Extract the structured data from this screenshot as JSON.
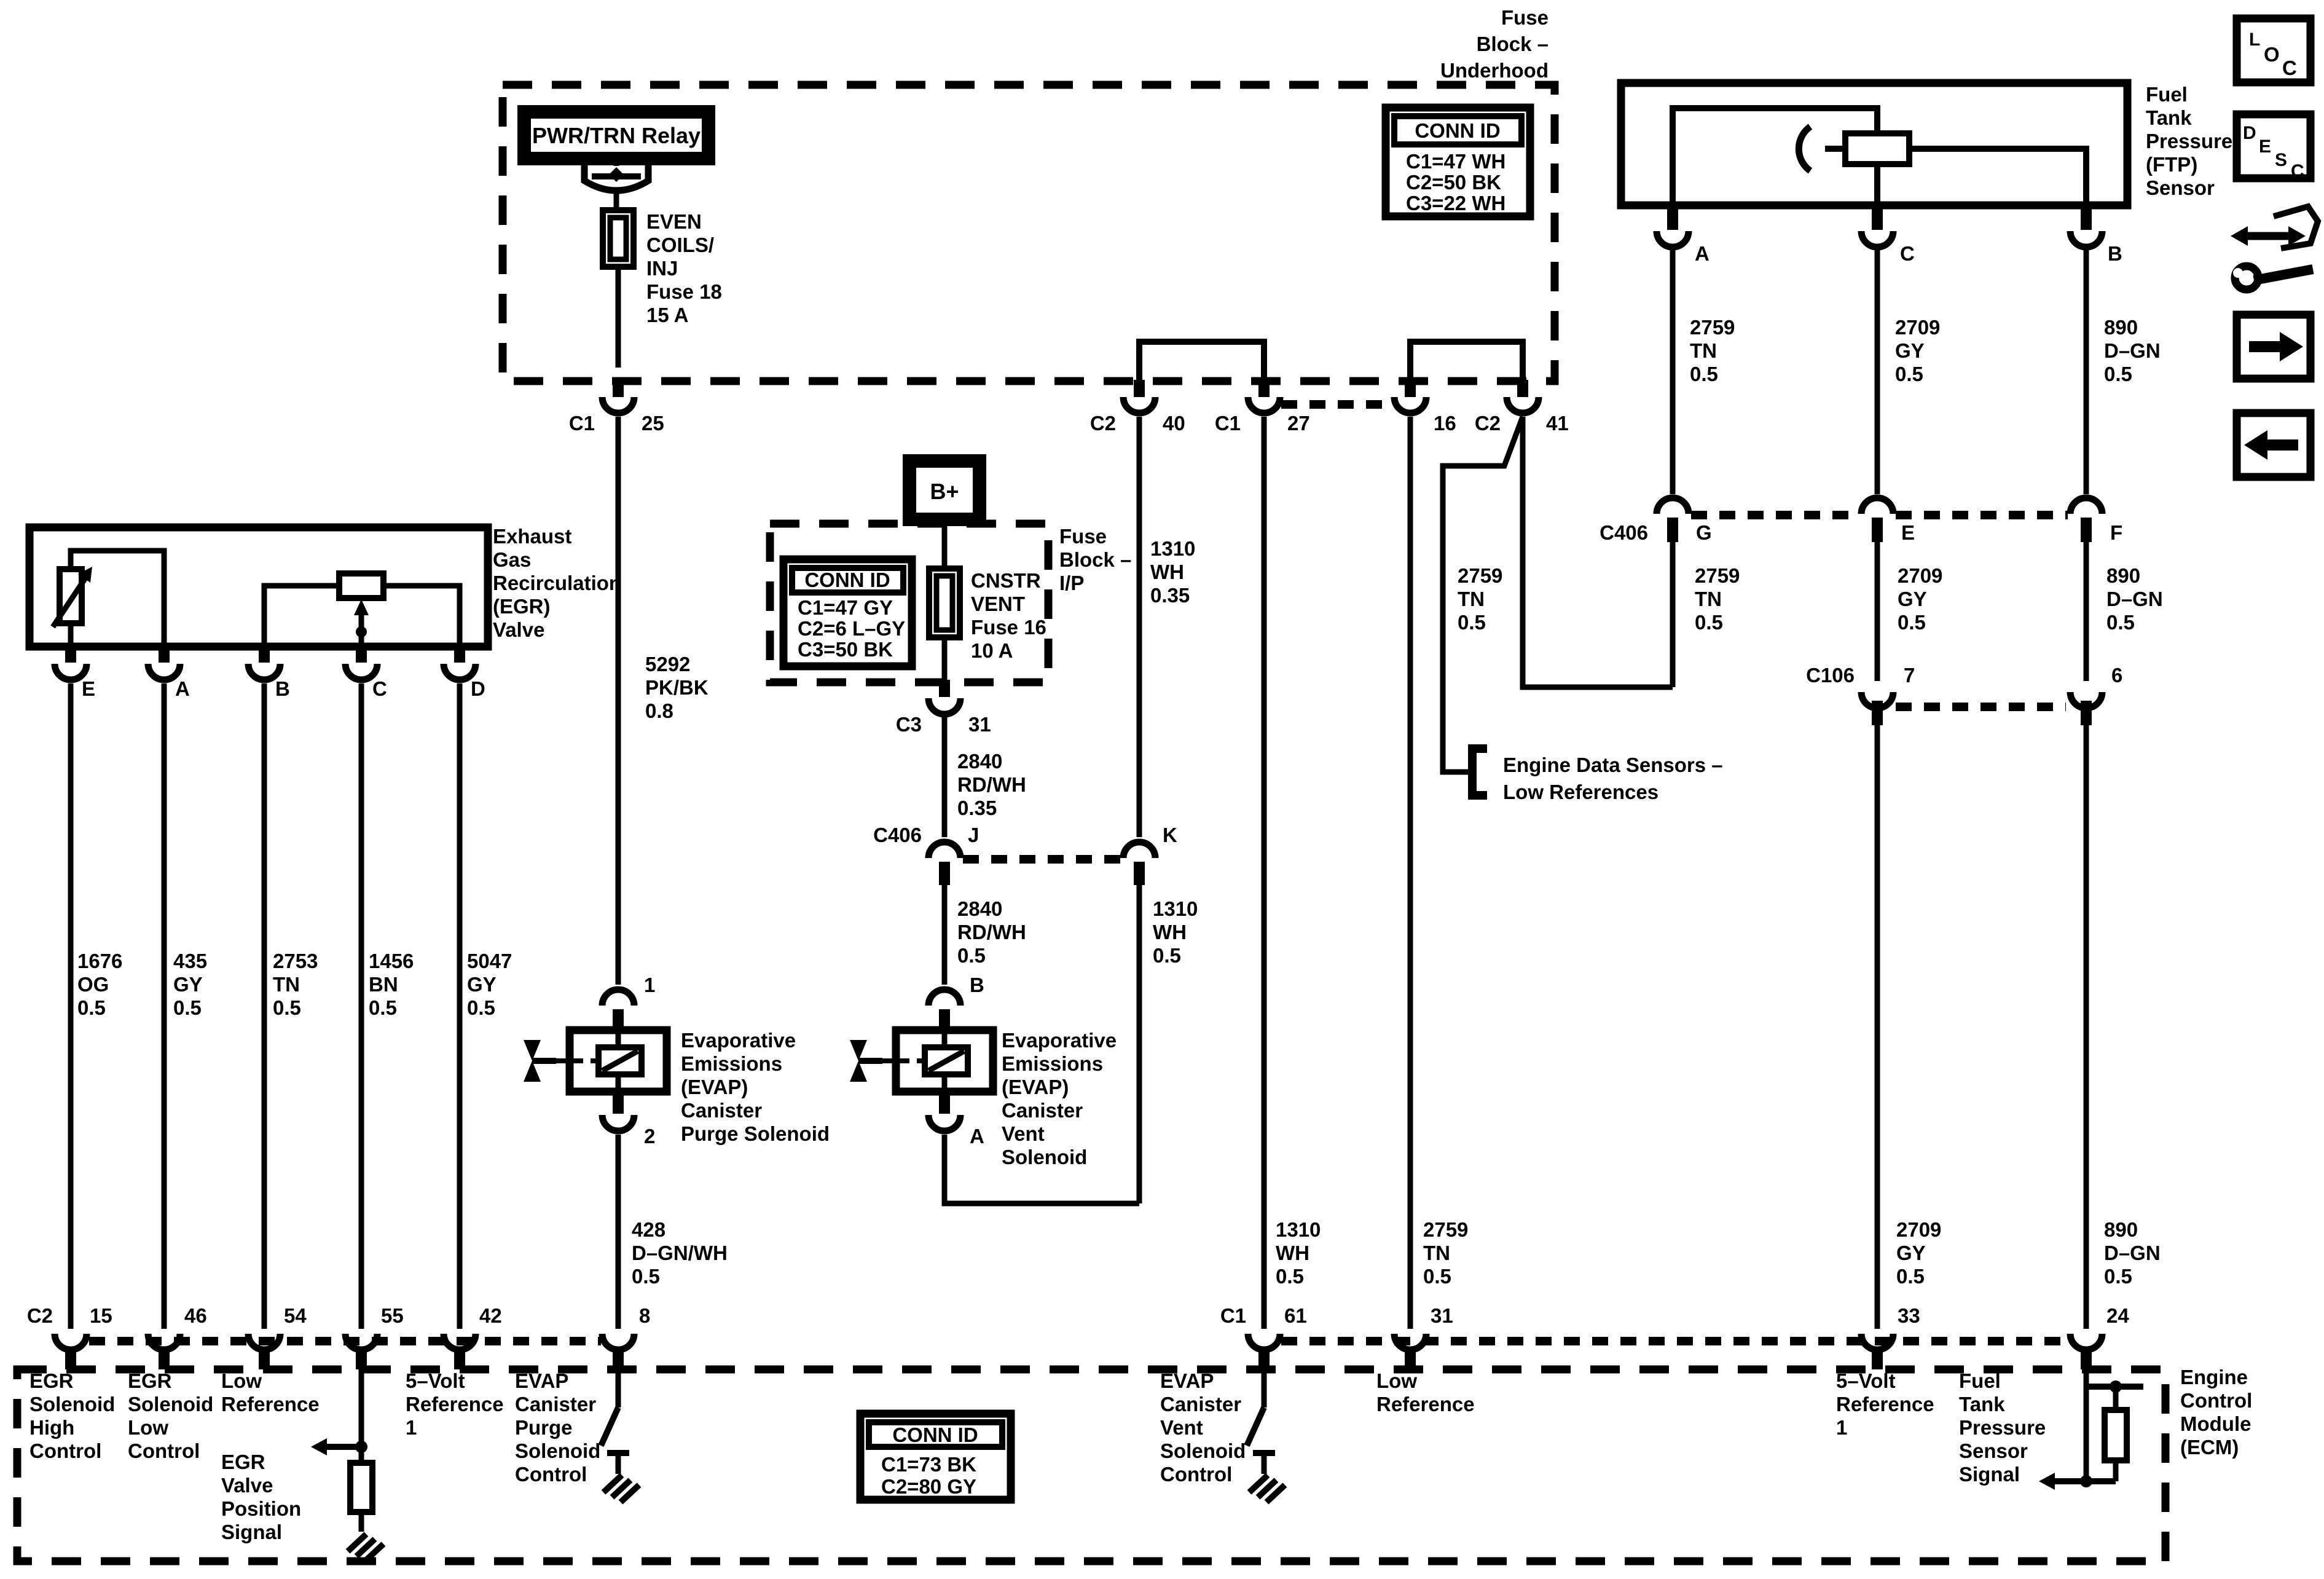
{
  "toolbar": {
    "loc": [
      "L",
      "O",
      "C"
    ],
    "desc": [
      "D",
      "E",
      "S",
      "C"
    ]
  },
  "underhood": {
    "title": [
      "Fuse",
      "Block –",
      "Underhood"
    ],
    "relay": "PWR/TRN Relay",
    "fuse": [
      "EVEN",
      "COILS/",
      "INJ",
      "Fuse 18",
      "15 A"
    ],
    "conn_id": {
      "header": "CONN ID",
      "rows": [
        "C1=47 WH",
        "C2=50 BK",
        "C3=22 WH"
      ]
    },
    "pins": {
      "c1a": "C1",
      "p25": "25",
      "c2a": "C2",
      "p40": "40",
      "c1b": "C1",
      "p27": "27",
      "p16": "16",
      "c2b": "C2",
      "p41": "41"
    }
  },
  "ip_block": {
    "title": [
      "Fuse",
      "Block –",
      "I/P"
    ],
    "bplus": "B+",
    "fuse": [
      "CNSTR",
      "VENT",
      "Fuse 16",
      "10 A"
    ],
    "conn_id": {
      "header": "CONN ID",
      "rows": [
        "C1=47 GY",
        "C2=6 L–GY",
        "C3=50 BK"
      ]
    },
    "pins": {
      "c3": "C3",
      "p31": "31"
    }
  },
  "ftp": {
    "label": [
      "Fuel",
      "Tank",
      "Pressure",
      "(FTP)",
      "Sensor"
    ],
    "pins": {
      "a": "A",
      "c": "C",
      "b": "B"
    }
  },
  "egr": {
    "label": [
      "Exhaust",
      "Gas",
      "Recirculation",
      "(EGR)",
      "Valve"
    ],
    "pins": {
      "e": "E",
      "a": "A",
      "b": "B",
      "c": "C",
      "d": "D"
    }
  },
  "purge": {
    "label": [
      "Evaporative",
      "Emissions",
      "(EVAP)",
      "Canister",
      "Purge Solenoid"
    ],
    "pins": {
      "p1": "1",
      "p2": "2"
    }
  },
  "vent": {
    "label": [
      "Evaporative",
      "Emissions",
      "(EVAP)",
      "Canister",
      "Vent",
      "Solenoid"
    ],
    "pins": {
      "b": "B",
      "a": "A"
    }
  },
  "c406L": {
    "name": "C406",
    "j": "J",
    "k": "K"
  },
  "c406R": {
    "name": "C406",
    "g": "G",
    "e": "E",
    "f": "F"
  },
  "c106": {
    "name": "C106",
    "p7": "7",
    "p6": "6"
  },
  "note": [
    "Engine Data Sensors –",
    "Low References"
  ],
  "wires": {
    "w5292": [
      "5292",
      "PK/BK",
      "0.8"
    ],
    "w1676": [
      "1676",
      "OG",
      "0.5"
    ],
    "w435": [
      "435",
      "GY",
      "0.5"
    ],
    "w2753": [
      "2753",
      "TN",
      "0.5"
    ],
    "w1456": [
      "1456",
      "BN",
      "0.5"
    ],
    "w5047": [
      "5047",
      "GY",
      "0.5"
    ],
    "w428": [
      "428",
      "D–GN/WH",
      "0.5"
    ],
    "w2840a": [
      "2840",
      "RD/WH",
      "0.35"
    ],
    "w2840b": [
      "2840",
      "RD/WH",
      "0.5"
    ],
    "w1310a": [
      "1310",
      "WH",
      "0.35"
    ],
    "w1310b": [
      "1310",
      "WH",
      "0.5"
    ],
    "w1310c": [
      "1310",
      "WH",
      "0.5"
    ],
    "w2759a": [
      "2759",
      "TN",
      "0.5"
    ],
    "w2759b": [
      "2759",
      "TN",
      "0.5"
    ],
    "w2759c": [
      "2759",
      "TN",
      "0.5"
    ],
    "w2759d": [
      "2759",
      "TN",
      "0.5"
    ],
    "w2709a": [
      "2709",
      "GY",
      "0.5"
    ],
    "w2709b": [
      "2709",
      "GY",
      "0.5"
    ],
    "w2709c": [
      "2709",
      "GY",
      "0.5"
    ],
    "w890a": [
      "890",
      "D–GN",
      "0.5"
    ],
    "w890b": [
      "890",
      "D–GN",
      "0.5"
    ],
    "w890c": [
      "890",
      "D–GN",
      "0.5"
    ]
  },
  "ecm": {
    "label": [
      "Engine",
      "Control",
      "Module",
      "(ECM)"
    ],
    "conn_id": {
      "header": "CONN ID",
      "rows": [
        "C1=73 BK",
        "C2=80 GY"
      ]
    },
    "pins": {
      "c2": "C2",
      "p15": "15",
      "p46": "46",
      "p54": "54",
      "p55": "55",
      "p42": "42",
      "p8": "8",
      "c1": "C1",
      "p61": "61",
      "p31": "31",
      "p33": "33",
      "p24": "24"
    },
    "fn": {
      "egr_high": [
        "EGR",
        "Solenoid",
        "High",
        "Control"
      ],
      "egr_low": [
        "EGR",
        "Solenoid",
        "Low",
        "Control"
      ],
      "low_ref_l": [
        "Low",
        "Reference"
      ],
      "egr_pos": [
        "EGR",
        "Valve",
        "Position",
        "Signal"
      ],
      "v5_l": [
        "5–Volt",
        "Reference",
        "1"
      ],
      "purge_ctl": [
        "EVAP",
        "Canister",
        "Purge",
        "Solenoid",
        "Control"
      ],
      "vent_ctl": [
        "EVAP",
        "Canister",
        "Vent",
        "Solenoid",
        "Control"
      ],
      "low_ref_r": [
        "Low",
        "Reference"
      ],
      "v5_r": [
        "5–Volt",
        "Reference",
        "1"
      ],
      "ftp_sig": [
        "Fuel",
        "Tank",
        "Pressure",
        "Sensor",
        "Signal"
      ]
    }
  }
}
